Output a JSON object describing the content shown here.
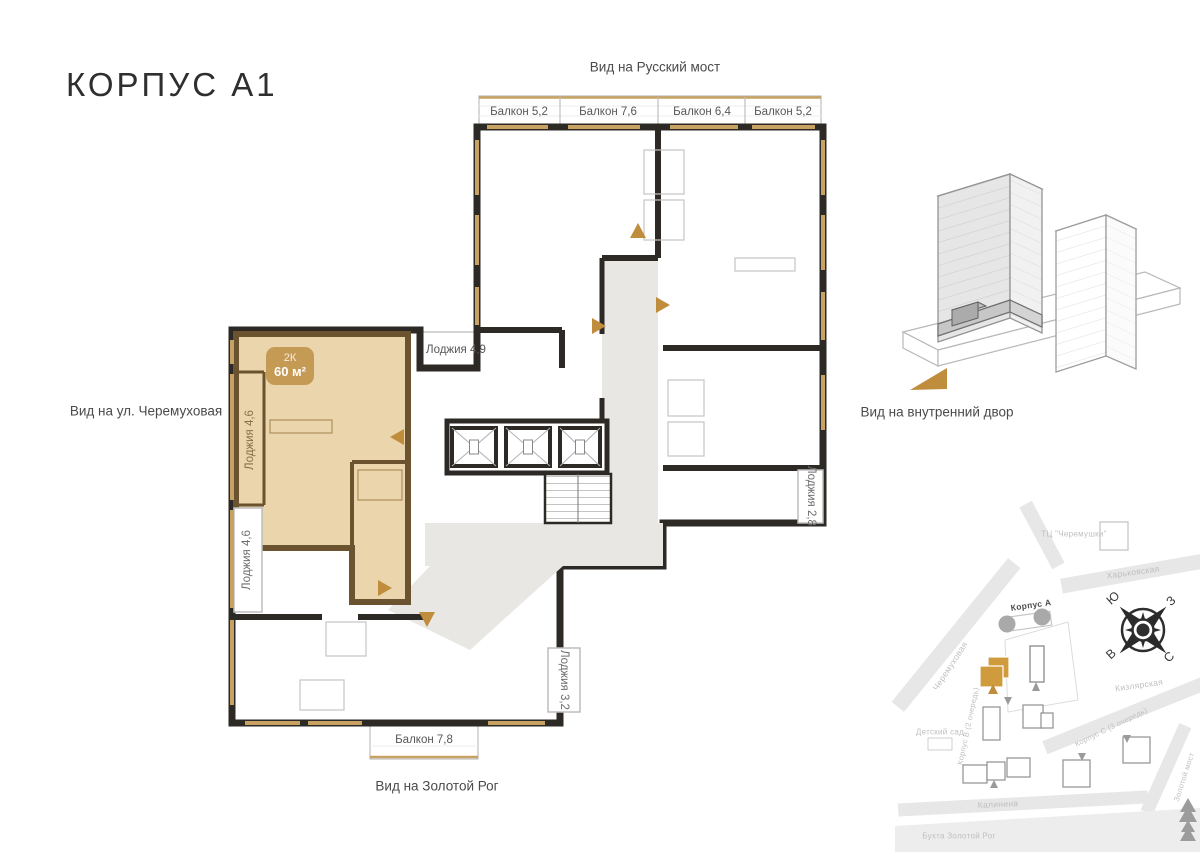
{
  "title": "КОРПУС А1",
  "views": {
    "top": "Вид на Русский мост",
    "left": "Вид на ул. Черемуховая",
    "bottom": "Вид на Золотой Рог",
    "right": "Вид на внутренний двор"
  },
  "apartment": {
    "type": "2К",
    "area": "60 м²"
  },
  "plan_labels": {
    "balcony_top_1": "Балкон 5,2",
    "balcony_top_2": "Балкон 7,6",
    "balcony_top_3": "Балкон 6,4",
    "balcony_top_4": "Балкон 5,2",
    "loggia_49": "Лоджия 4,9",
    "loggia_46_a": "Лоджия 4,6",
    "loggia_46_b": "Лоджия 4,6",
    "loggia_28": "Лоджия 2,8",
    "loggia_32": "Лоджия 3,2",
    "balcony_78": "Балкон 7,8"
  },
  "map": {
    "mall": "ТЦ \"Черемушки\"",
    "street_kharkovskaya": "Харьковская",
    "street_cheremukhovaya": "Черемуховая",
    "street_kizlyarskaya": "Кизлярская",
    "street_kalinina": "Калинина",
    "korpus_a": "Корпус А",
    "korpus_b": "Корпус В (2 очередь)",
    "korpus_c": "Корпус С (3 очередь)",
    "kindergarten": "Детский сад",
    "bay": "Бухта Золотой Рог",
    "bridge": "Золотой мост",
    "compass": {
      "north": "С",
      "south": "Ю",
      "east": "В",
      "west": "З"
    }
  },
  "colors": {
    "wall": "#2d2a26",
    "highlight_fill": "#ead5ac",
    "highlight_wall": "#6b5330",
    "badge": "#c59a55",
    "window": "#c8a262",
    "corridor": "#e8e7e4",
    "accent_arrow": "#c08d3c",
    "map_gold": "#cf9b3d"
  }
}
